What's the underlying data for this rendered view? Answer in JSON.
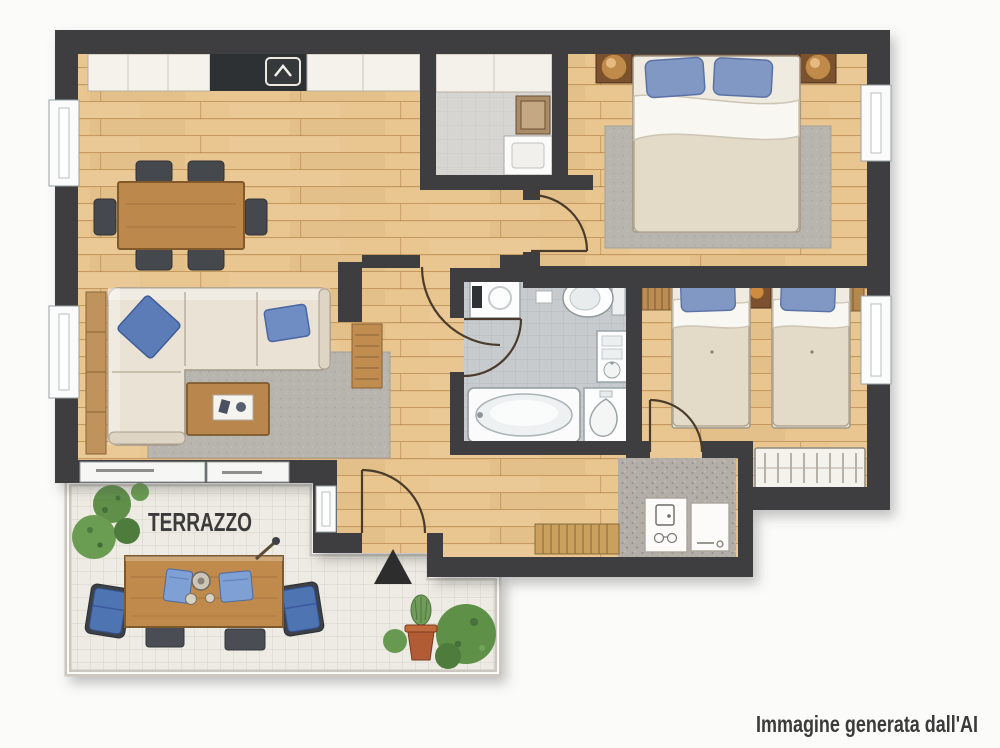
{
  "canvas": {
    "width": 1000,
    "height": 748
  },
  "labels": {
    "terrace": "TERRAZZO",
    "caption": "Immagine generata dall'AI"
  },
  "icons": {
    "hood": "chevron-up",
    "entrance_marker": "filled-triangle-up"
  },
  "colors": {
    "background": "#fbfbfa",
    "wall": "#3e3e40",
    "wood_floor": "#e9c690",
    "wood_line": "#a87640",
    "terrace_tile": "#edebe3",
    "bath_tile": "#c7cbcd",
    "laundry_floor": "#d6d5d2",
    "speckle_floor": "#b3afa8",
    "rug": "#b8b5af",
    "sofa": "#e9e2d5",
    "duvet": "#e3dac8",
    "sheet": "#f9f7f1",
    "pillow_blue": "#8198c5",
    "accent_blue": "#4f74b2",
    "furniture_wood": "#bc884c",
    "outdoor_wood": "#c08a4d",
    "dark_wood": "#7c5130",
    "plant_green": "#5f8f49",
    "terracotta": "#b25c35",
    "fixture_white": "#fdfdfd",
    "chair_dark": "#45484c",
    "marker": "#2d2d2d",
    "text": "#3b3b3b"
  }
}
